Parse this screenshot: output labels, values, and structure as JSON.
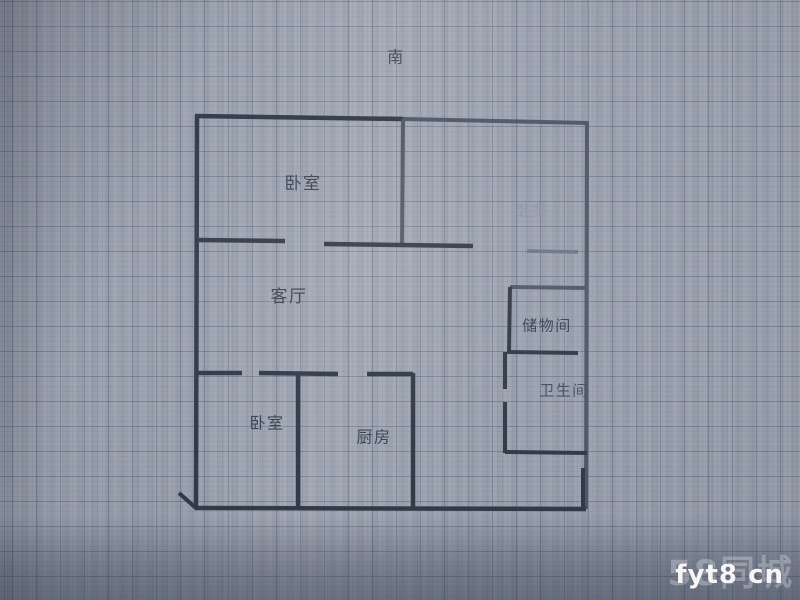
{
  "colors": {
    "paper_base": "#9aa1ae",
    "paper_light": "#aeb4bf",
    "paper_dark": "#7b8292",
    "grid_major": "rgba(58,68,95,0.30)",
    "grid_minor": "rgba(64,74,100,0.08)",
    "wall_dark": "#333a48",
    "wall_mid": "#515969",
    "wall_light": "#6d7587",
    "label_dark": "#3c4352",
    "label_mid": "#4a5262",
    "label_faint": "#8e95a4",
    "watermark_white": "rgba(255,255,255,0.93)",
    "watermark_brand": "rgba(238,242,248,0.30)"
  },
  "plan": {
    "compass": {
      "name": "compass-south-label",
      "text": "南",
      "x": 396,
      "y": 58,
      "size": 16,
      "tone": "mid"
    },
    "labels": [
      {
        "name": "bedroom-top-left-label",
        "text": "卧室",
        "x": 303,
        "y": 184,
        "size": 17,
        "tone": "dark"
      },
      {
        "name": "bedroom-right-label",
        "text": "卧室",
        "x": 532,
        "y": 211,
        "size": 15,
        "tone": "faint"
      },
      {
        "name": "living-room-label",
        "text": "客厅",
        "x": 289,
        "y": 297,
        "size": 17,
        "tone": "dark"
      },
      {
        "name": "storage-room-label",
        "text": "储物间",
        "x": 547,
        "y": 326,
        "size": 15,
        "tone": "dark"
      },
      {
        "name": "bathroom-label",
        "text": "卫生间",
        "x": 564,
        "y": 391,
        "size": 15,
        "tone": "mid"
      },
      {
        "name": "bedroom-bottom-left-label",
        "text": "卧室",
        "x": 267,
        "y": 424,
        "size": 16,
        "tone": "dark"
      },
      {
        "name": "kitchen-label",
        "text": "厨房",
        "x": 374,
        "y": 438,
        "size": 16,
        "tone": "dark"
      }
    ],
    "walls": [
      {
        "name": "wall-top-left-span",
        "x1": 195,
        "y1": 116,
        "x2": 403,
        "y2": 119,
        "w": 4.5,
        "tone": "dark"
      },
      {
        "name": "wall-top-right-span",
        "x1": 403,
        "y1": 119,
        "x2": 589,
        "y2": 123,
        "w": 4,
        "tone": "mid"
      },
      {
        "name": "wall-left",
        "x1": 197,
        "y1": 115,
        "x2": 196,
        "y2": 509,
        "w": 4.5,
        "tone": "dark"
      },
      {
        "name": "wall-right",
        "x1": 587,
        "y1": 122,
        "x2": 586,
        "y2": 509,
        "w": 4,
        "tone": "mid"
      },
      {
        "name": "wall-right-inset",
        "x1": 583,
        "y1": 468,
        "x2": 583,
        "y2": 509,
        "w": 4,
        "tone": "dark"
      },
      {
        "name": "wall-bottom",
        "x1": 195,
        "y1": 508,
        "x2": 586,
        "y2": 509,
        "w": 4.5,
        "tone": "dark"
      },
      {
        "name": "wall-corner-diagonal",
        "x1": 179,
        "y1": 493,
        "x2": 197,
        "y2": 509,
        "w": 4,
        "tone": "dark"
      },
      {
        "name": "wall-bedrooms-divider",
        "x1": 403,
        "y1": 119,
        "x2": 402,
        "y2": 247,
        "w": 4,
        "tone": "mid"
      },
      {
        "name": "wall-living-top-a",
        "x1": 196,
        "y1": 240,
        "x2": 285,
        "y2": 241,
        "w": 4.5,
        "tone": "dark"
      },
      {
        "name": "wall-living-top-b",
        "x1": 324,
        "y1": 244,
        "x2": 473,
        "y2": 246,
        "w": 4.5,
        "tone": "dark"
      },
      {
        "name": "wall-bedroom-right-bottom",
        "x1": 527,
        "y1": 251,
        "x2": 578,
        "y2": 252,
        "w": 3.5,
        "tone": "light"
      },
      {
        "name": "wall-storage-top",
        "x1": 510,
        "y1": 287,
        "x2": 587,
        "y2": 288,
        "w": 4,
        "tone": "mid"
      },
      {
        "name": "wall-storage-left",
        "x1": 510,
        "y1": 287,
        "x2": 509,
        "y2": 352,
        "w": 4,
        "tone": "dark"
      },
      {
        "name": "wall-storage-bottom",
        "x1": 507,
        "y1": 352,
        "x2": 578,
        "y2": 353,
        "w": 4,
        "tone": "dark"
      },
      {
        "name": "wall-bath-left-upper",
        "x1": 505,
        "y1": 352,
        "x2": 505,
        "y2": 389,
        "w": 4,
        "tone": "dark"
      },
      {
        "name": "wall-bath-left-lower",
        "x1": 505,
        "y1": 402,
        "x2": 505,
        "y2": 453,
        "w": 4,
        "tone": "dark"
      },
      {
        "name": "wall-bath-bottom",
        "x1": 505,
        "y1": 452,
        "x2": 587,
        "y2": 453,
        "w": 4,
        "tone": "dark"
      },
      {
        "name": "wall-lower-top-a",
        "x1": 196,
        "y1": 373,
        "x2": 242,
        "y2": 373,
        "w": 4.5,
        "tone": "dark"
      },
      {
        "name": "wall-lower-top-b",
        "x1": 259,
        "y1": 373,
        "x2": 338,
        "y2": 374,
        "w": 4.5,
        "tone": "dark"
      },
      {
        "name": "wall-lower-top-c",
        "x1": 367,
        "y1": 374,
        "x2": 413,
        "y2": 374,
        "w": 4.5,
        "tone": "dark"
      },
      {
        "name": "wall-bedroom-kitchen-divider",
        "x1": 298,
        "y1": 373,
        "x2": 298,
        "y2": 508,
        "w": 4.5,
        "tone": "dark"
      },
      {
        "name": "wall-kitchen-right",
        "x1": 413,
        "y1": 373,
        "x2": 413,
        "y2": 508,
        "w": 4.5,
        "tone": "dark"
      }
    ]
  },
  "watermark": {
    "site_text": "fyt8 cn",
    "brand_text": "58同城"
  }
}
